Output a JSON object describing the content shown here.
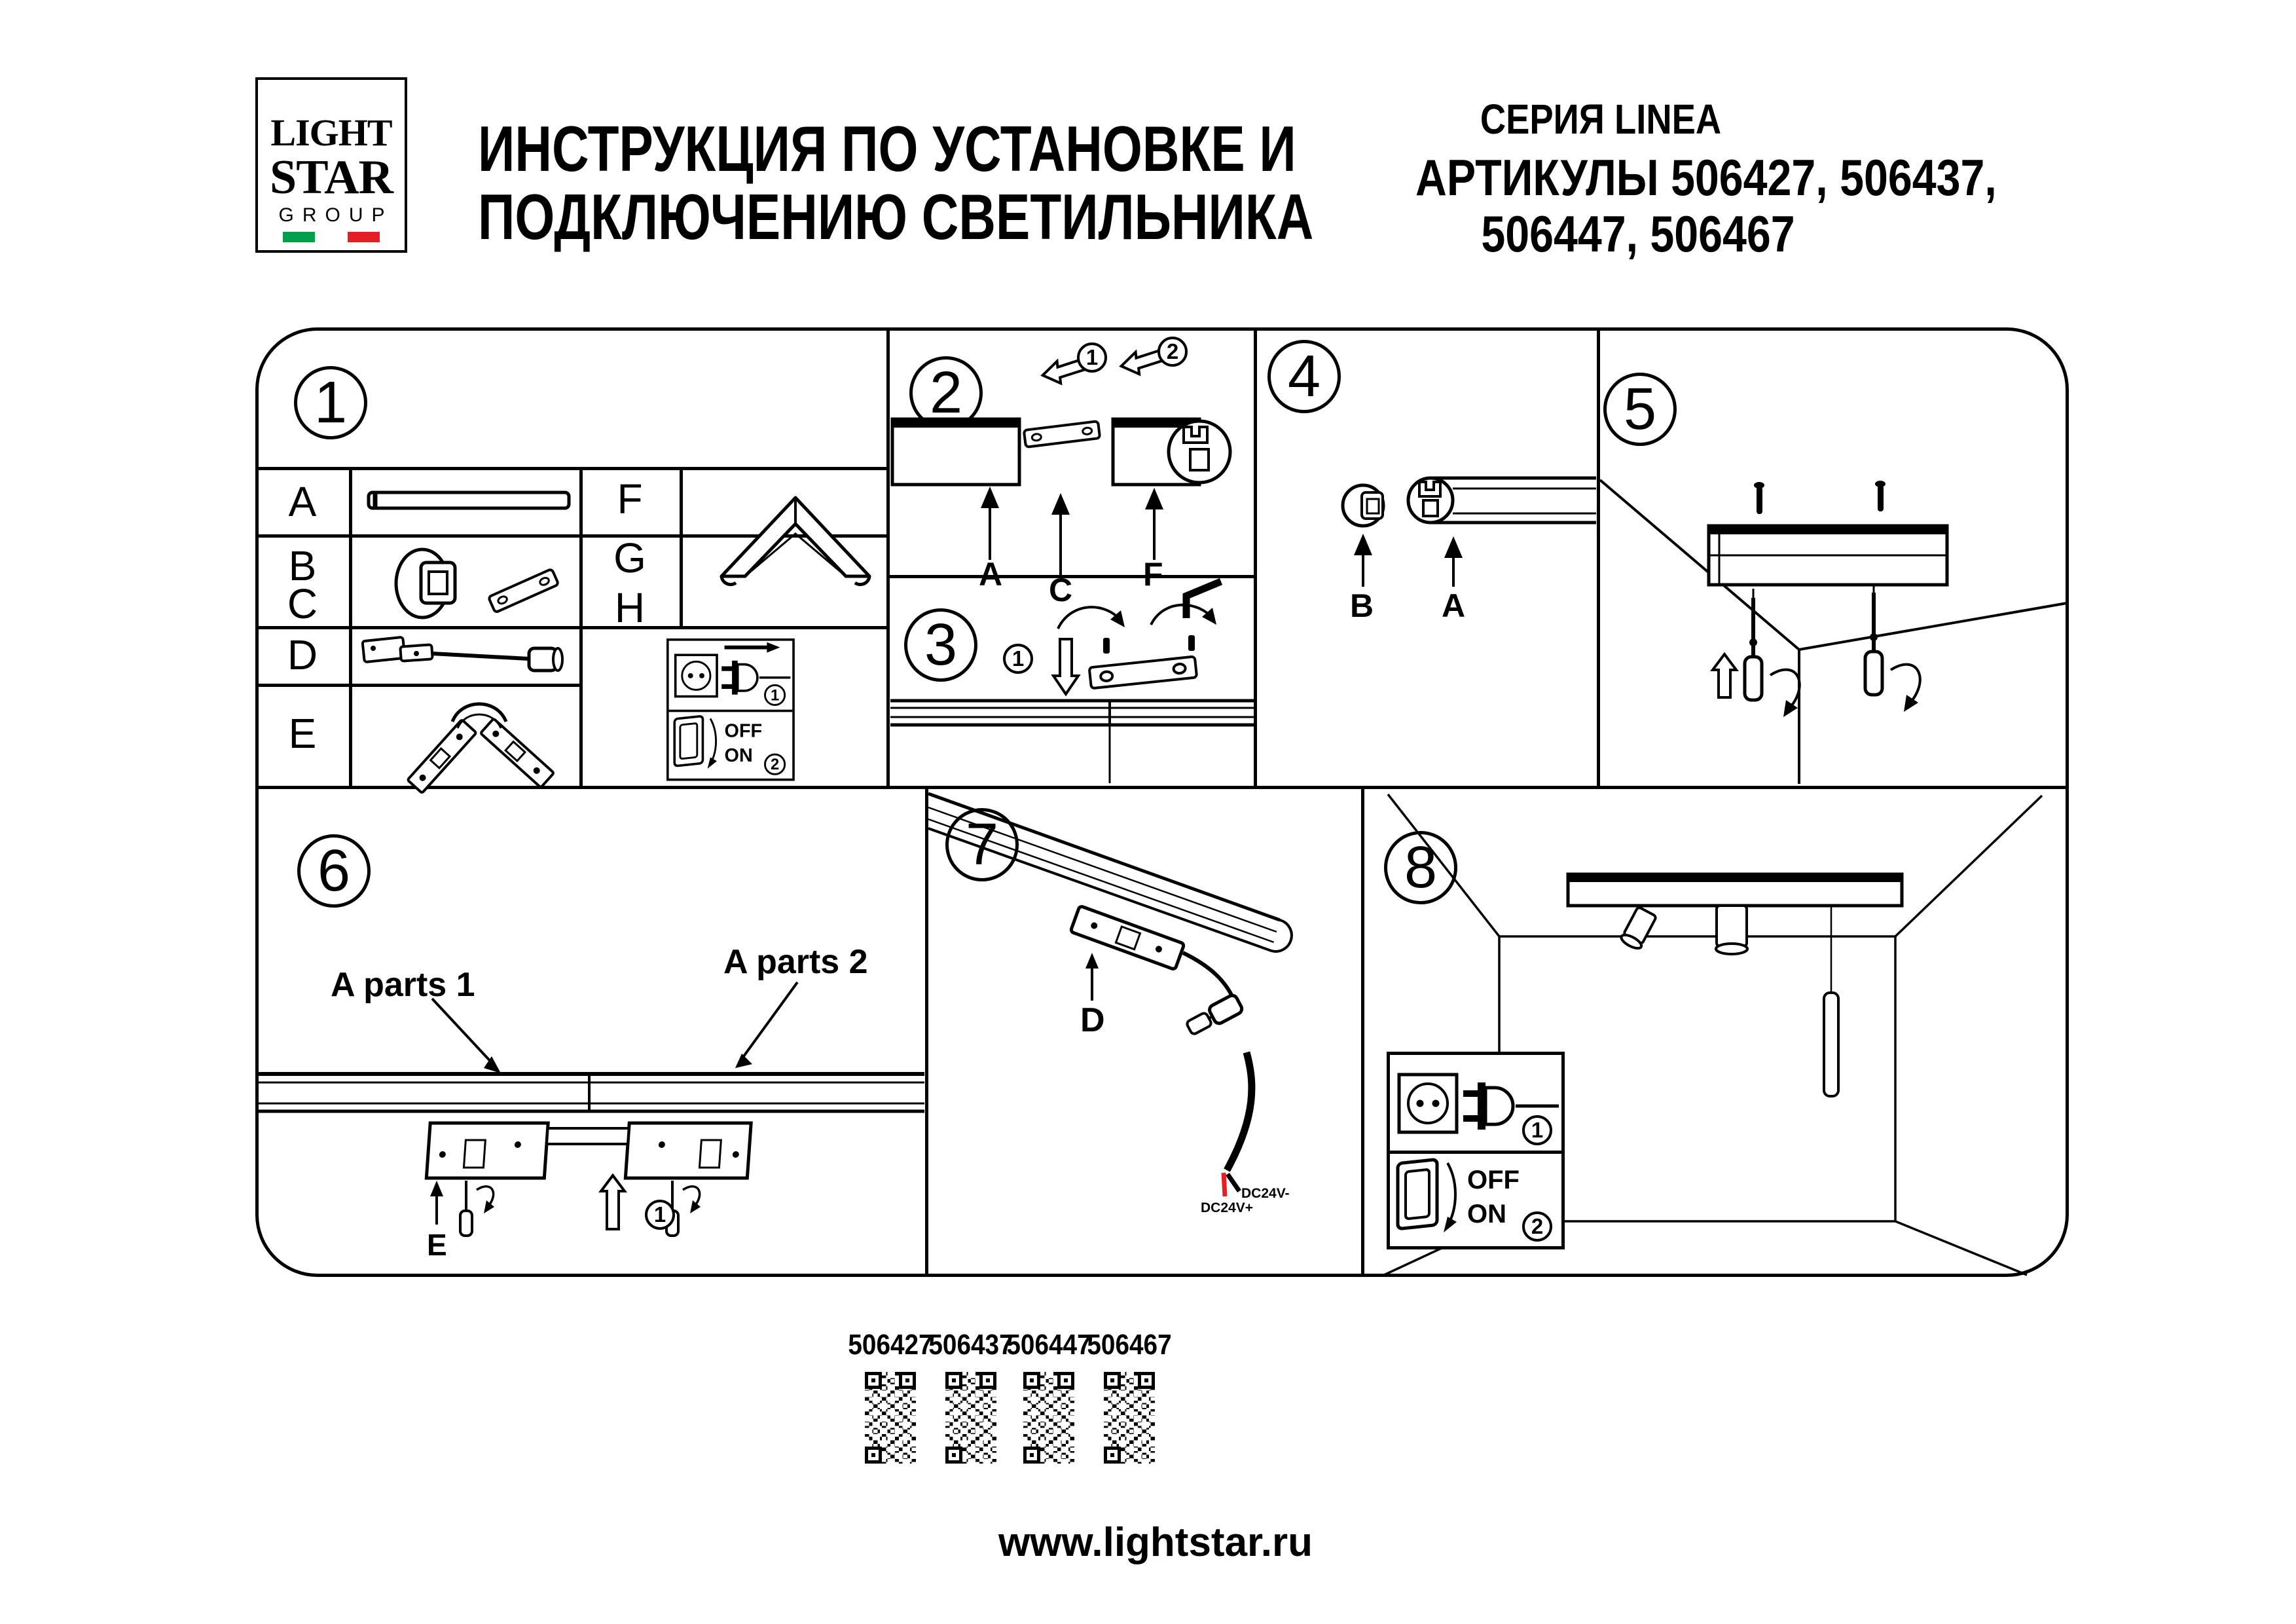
{
  "header": {
    "logo": {
      "light": "LIGHT",
      "star": "STAR",
      "group": "GROUP"
    },
    "title_line1": "ИНСТРУКЦИЯ ПО УСТАНОВКЕ И",
    "title_line2": "ПОДКЛЮЧЕНИЮ СВЕТИЛЬНИКА",
    "series": "СЕРИЯ LINEA",
    "articles_line1": "АРТИКУЛЫ 506427, 506437,",
    "articles_line2": "506447, 506467"
  },
  "steps": {
    "n1": "1",
    "n2": "2",
    "n3": "3",
    "n4": "4",
    "n5": "5",
    "n6": "6",
    "n7": "7",
    "n8": "8"
  },
  "parts": {
    "a": "A",
    "b": "B",
    "c": "C",
    "d": "D",
    "e": "E",
    "f": "F",
    "g": "G",
    "h": "H"
  },
  "step2": {
    "arrow1": "1",
    "arrow2": "2",
    "label_a": "A",
    "label_c": "C",
    "label_f": "F"
  },
  "step3": {
    "num1": "1"
  },
  "step4": {
    "label_b": "B",
    "label_a": "A"
  },
  "step6": {
    "parts1": "A parts 1",
    "parts2": "A parts 2",
    "label_e": "E",
    "num1": "1"
  },
  "step7": {
    "label_d": "D",
    "wire_neg": "DC24V-",
    "wire_pos": "DC24V+"
  },
  "power": {
    "off": "OFF",
    "on": "ON",
    "num1": "1",
    "num2": "2"
  },
  "qr_codes": [
    {
      "article": "506427"
    },
    {
      "article": "506437"
    },
    {
      "article": "506447"
    },
    {
      "article": "506467"
    }
  ],
  "footer": {
    "website": "www.lightstar.ru"
  },
  "icons": {
    "socket": "socket-icon",
    "plug": "plug-icon",
    "switch": "rocker-switch-icon",
    "screwdriver": "screwdriver-icon",
    "allen_key": "allen-key-icon",
    "qr": "qr-code"
  },
  "colors": {
    "ink": "#000000",
    "flag_green": "#00A04C",
    "flag_red": "#E31E24",
    "wire_red": "#EC1C24"
  }
}
